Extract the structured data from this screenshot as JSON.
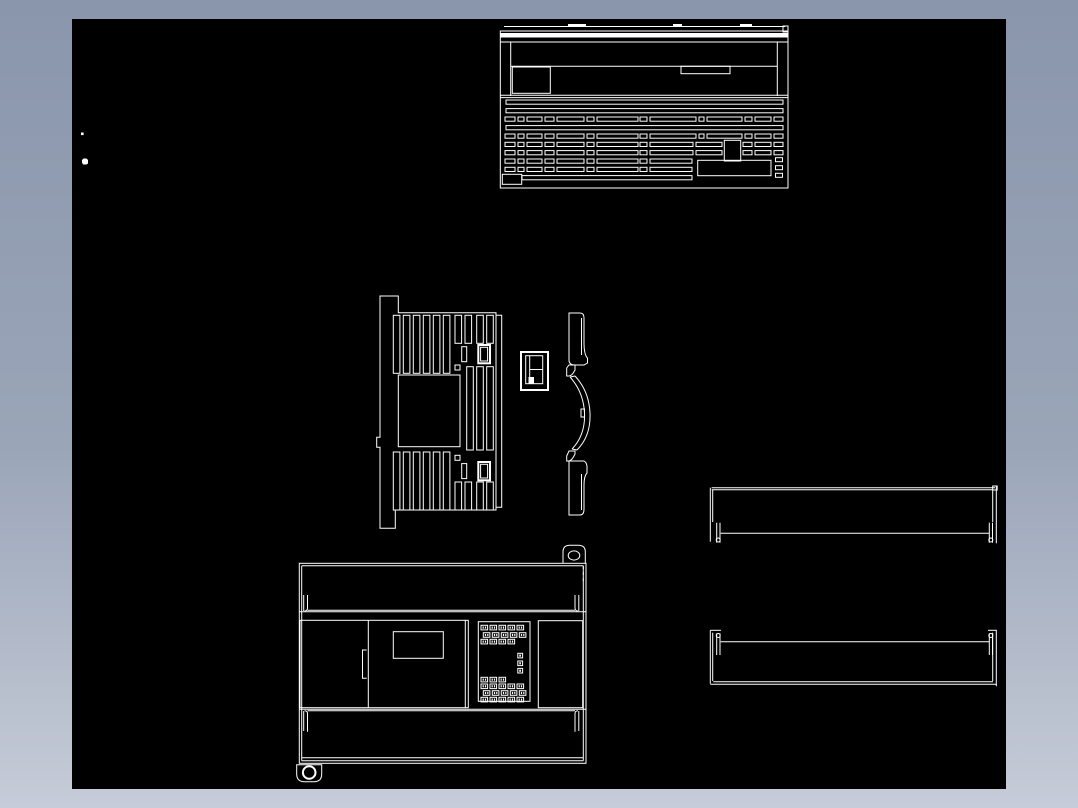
{
  "frame": {
    "gradient_top": "#8a96ac",
    "gradient_mid": "#9aa5b8",
    "gradient_bottom": "#c6ccd8"
  },
  "canvas": {
    "background": "#000000",
    "line_color": "#ffffff",
    "x": 72,
    "y": 19,
    "width": 934,
    "height": 770
  },
  "drawing": {
    "components": [
      {
        "id": "top-view",
        "name": "enclosure top view with vent slot rows"
      },
      {
        "id": "side-view",
        "name": "enclosure side view with vent slots and window"
      },
      {
        "id": "clip-detail",
        "name": "small mounting clip detail"
      },
      {
        "id": "side-profile",
        "name": "curved side cover profile"
      },
      {
        "id": "front-view",
        "name": "enclosure front view with door, LED block and terminal covers"
      },
      {
        "id": "din-rail-upper",
        "name": "mounting rail profile, upper"
      },
      {
        "id": "din-rail-lower",
        "name": "mounting rail profile, lower"
      },
      {
        "id": "stray-marks",
        "name": "stray plot marks"
      }
    ]
  }
}
